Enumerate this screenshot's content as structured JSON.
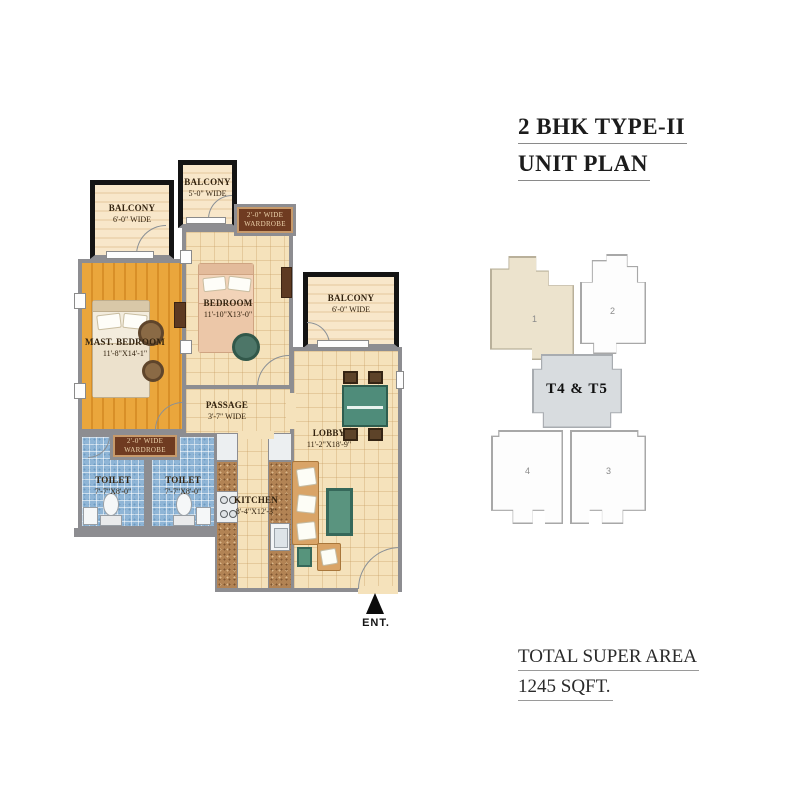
{
  "title": {
    "line1": "2 BHK TYPE-II",
    "line2": "UNIT PLAN"
  },
  "footer": {
    "line1": "TOTAL SUPER AREA",
    "line2": "1245 SQFT."
  },
  "entry": {
    "label": "ENT."
  },
  "rooms": {
    "balcony_top_left": {
      "name": "BALCONY",
      "dims": "6'-0\" WIDE"
    },
    "balcony_top_mid": {
      "name": "BALCONY",
      "dims": "5'-0\" WIDE"
    },
    "balcony_right": {
      "name": "BALCONY",
      "dims": "6'-0\" WIDE"
    },
    "wardrobe_top": {
      "line1": "2'-0\" WIDE",
      "line2": "WARDROBE"
    },
    "wardrobe_mid": {
      "line1": "2'-0\" WIDE",
      "line2": "WARDROBE"
    },
    "master_bedroom": {
      "name": "MAST. BEDROOM",
      "dims": "11'-8\"X14'-1\""
    },
    "bedroom": {
      "name": "BEDROOM",
      "dims": "11'-10\"X13'-0\""
    },
    "passage": {
      "name": "PASSAGE",
      "dims": "3'-7\" WIDE"
    },
    "lobby": {
      "name": "LOBBY",
      "dims": "11'-2\"X18'-9\""
    },
    "toilet1": {
      "name": "TOILET",
      "dims": "7'-7\"X8'-0\""
    },
    "toilet2": {
      "name": "TOILET",
      "dims": "7'-7\"X8'-0\""
    },
    "kitchen": {
      "name": "KITCHEN",
      "dims": "8'-4\"X12'-3\""
    }
  },
  "keyplan": {
    "core": "T4 & T5",
    "units": {
      "u1": "1",
      "u2": "2",
      "u3": "3",
      "u4": "4"
    }
  },
  "colors": {
    "wall": "#8d8d91",
    "balcony_border": "#141414",
    "wood_floor": "#e8a23c",
    "tile_floor": "#f5e2bb",
    "toilet_floor": "#8fb5d6",
    "wardrobe": "#6f3b21",
    "counter_granite": "#b28354",
    "dining_table": "#4f8c7a",
    "sofa": "#d9a467",
    "keyplan_highlight": "#ece3cd",
    "keyplan_core": "#d8dcdf"
  }
}
